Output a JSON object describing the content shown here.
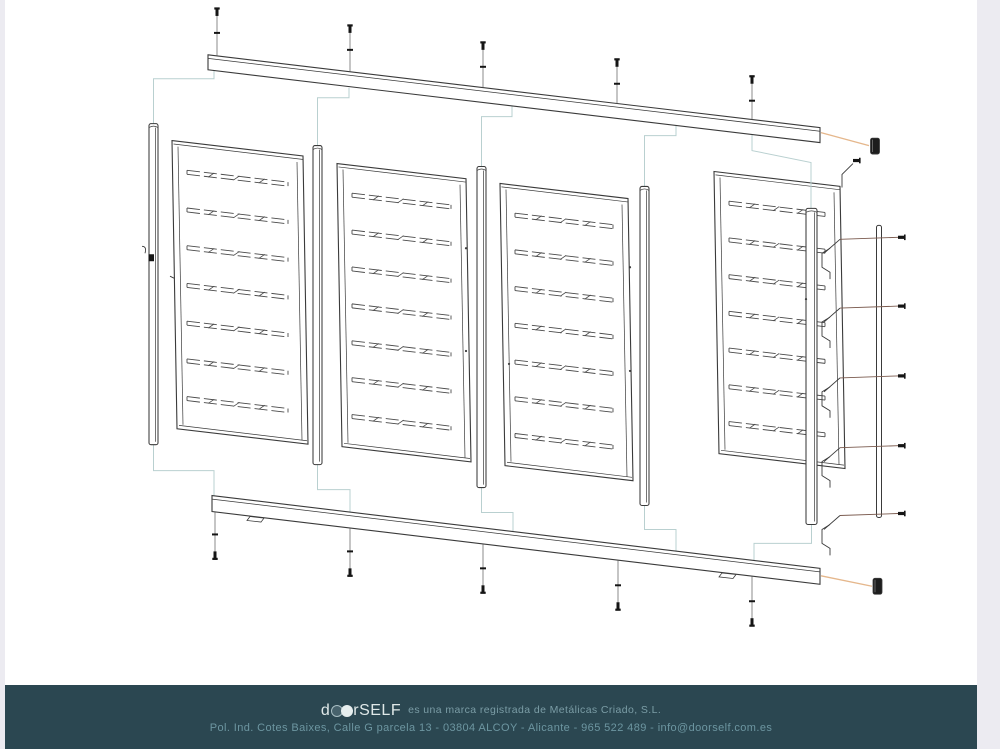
{
  "page": {
    "canvas_background": "#ecebf1",
    "paper_background": "#ffffff"
  },
  "diagram": {
    "description": "Exploded assembly drawing of a four-panel slatted gate / fence kit",
    "colors": {
      "line": "#3a3a3a",
      "slat": "#4a4a4a",
      "thin": "#5a5a5a",
      "construction": "#b9d0d0",
      "leader_orange": "#e5b78c",
      "leader_brown": "#7a5a4e",
      "cap_fill": "#1d1d1d",
      "screw": "#151515"
    },
    "parts": {
      "panels": 4,
      "posts": 5,
      "top_rail": 1,
      "bottom_rail": 1,
      "top_screws": 5,
      "bottom_screws": 5,
      "end_caps": 2,
      "side_fixings": 6,
      "cover_strip": 1
    }
  },
  "footer": {
    "background": "#2b4751",
    "logo_prefix": "d",
    "logo_suffix": "rSELF",
    "logo_color": "#dfe8e8",
    "dot_dark": "#47626c",
    "dot_ring": "#a9bec3",
    "dot_light": "#e6eeee",
    "trademark_text": "es una marca registrada de Metálicas Criado, S.L.",
    "trademark_color": "#7b9da6",
    "address_line": "Pol. Ind. Cotes Baixes, Calle G parcela 13 - 03804 ALCOY - Alicante - 965 522 489 - info@doorself.com.es",
    "address_color": "#6d96a1"
  }
}
